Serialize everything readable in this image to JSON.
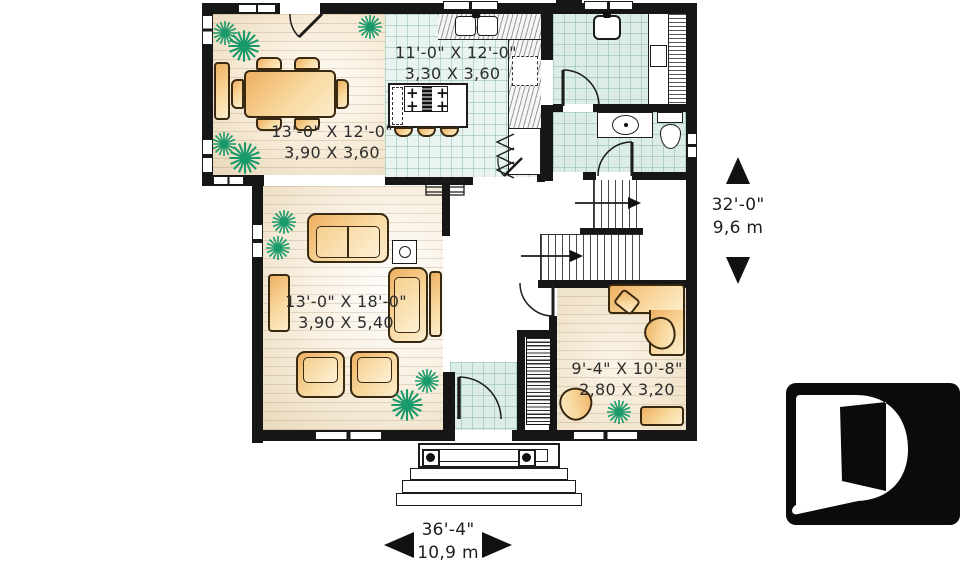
{
  "rooms": {
    "kitchen": {
      "dims_ft": "11'-0\" X 12'-0\"",
      "dims_m": "3,30 X 3,60"
    },
    "dining": {
      "dims_ft": "13'-0\" X 12'-0\"",
      "dims_m": "3,90 X 3,60"
    },
    "living": {
      "dims_ft": "13'-0\" X 18'-0\"",
      "dims_m": "3,90 X 5,40"
    },
    "office": {
      "dims_ft": "9'-4\" X 10'-8\"",
      "dims_m": "2,80 X 3,20"
    }
  },
  "dimensions": {
    "height": {
      "ft": "32'-0\"",
      "m": "9,6 m"
    },
    "width": {
      "ft": "36'-4\"",
      "m": "10,9 m"
    }
  },
  "logo": {
    "letter": "D"
  },
  "colors": {
    "wall": "#161616",
    "tile": "#dcece7",
    "wood": "#f3e6cf",
    "furniture": "#f2bd72",
    "plant": "#1a9a6a",
    "logo_bg": "#0b0b0b"
  }
}
